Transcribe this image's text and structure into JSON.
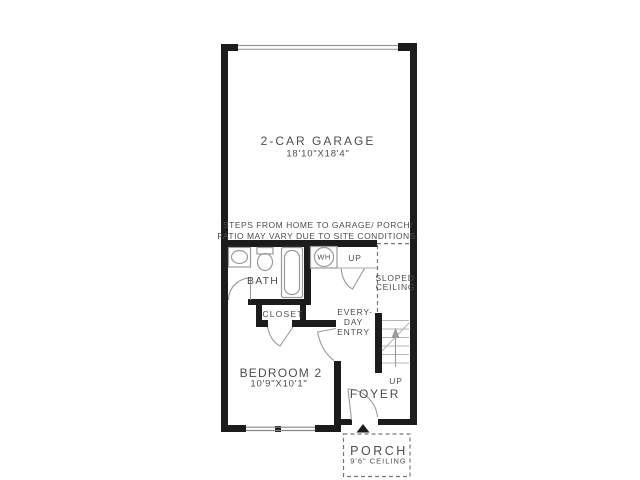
{
  "note": {
    "line1": "STEPS FROM HOME TO GARAGE/ PORCH/",
    "line2": "PATIO MAY VARY DUE TO SITE CONDITIONS."
  },
  "rooms": {
    "garage": {
      "name": "2-CAR GARAGE",
      "dimensions": "18'10\"X18'4\""
    },
    "bath": {
      "name": "BATH"
    },
    "closet": {
      "name": "CLOSET"
    },
    "bedroom2": {
      "name": "BEDROOM 2",
      "dimensions": "10'9\"X10'1\""
    },
    "everyday_entry": {
      "line1": "EVERY-",
      "line2": "DAY",
      "line3": "ENTRY"
    },
    "foyer": {
      "name": "FOYER"
    },
    "porch": {
      "name": "PORCH",
      "ceiling": "9'6\" CEILING"
    },
    "sloped_ceiling": {
      "line1": "SLOPED",
      "line2": "CEILING"
    }
  },
  "labels": {
    "water_heater": "WH",
    "up_garage_steps": "UP",
    "up_stairs": "UP"
  },
  "colors": {
    "wall": "#1c1c1c",
    "text": "#4d4d4d",
    "fixture_line": "#9a9a9a",
    "stair_line": "#b5b5b5",
    "dashed_line": "#777777",
    "background": "#ffffff"
  }
}
